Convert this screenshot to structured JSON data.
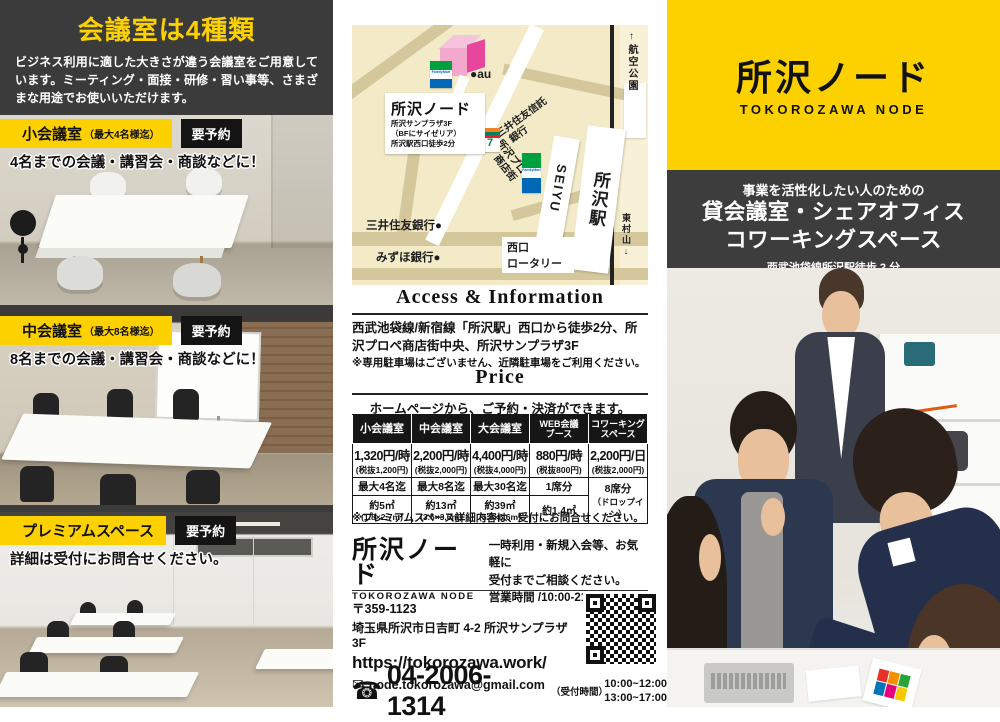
{
  "brand": {
    "logo_jp": "所沢ノード",
    "logo_en": "TOKOROZAWA NODE"
  },
  "colors": {
    "yellow": "#fdd000",
    "dark": "#3b3b3b",
    "black": "#161616",
    "map_bg": "#f3eac8",
    "pink": "#e8459f"
  },
  "icons": {
    "email": "✉",
    "phone": "☎"
  },
  "left": {
    "title": "会議室は4種類",
    "description": "ビジネス利用に適した大きさが違う会議室をご用意しています。ミーティング・面接・研修・習い事等、さまざまな用途でお使いいただけます。",
    "rooms": [
      {
        "name": "小会議室",
        "note": "（最大4名様迄）",
        "badge": "要予約",
        "caption": "4名までの会議・講習会・商談などに！"
      },
      {
        "name": "中会議室",
        "note": "（最大8名様迄）",
        "badge": "要予約",
        "caption": "8名までの会議・講習会・商談などに！"
      },
      {
        "name": "プレミアムスペース",
        "note": "",
        "badge": "要予約",
        "caption": "詳細は受付にお問合せください。"
      }
    ]
  },
  "map": {
    "callout": {
      "title": "所沢ノード",
      "line1": "所沢サンプラザ3F",
      "line2": "（BFにサイゼリア）",
      "line3": "所沢駅西口徒歩2分"
    },
    "labels": {
      "airport_park": "↑航空公園",
      "au": "●au",
      "smbc_trust1": "●三井住友信託",
      "smbc_trust2": "銀行",
      "prope1": "所沢プロペ",
      "prope2": "商店街",
      "seiyu": "SEIYU",
      "station": "所沢駅",
      "smbc": "三井住友銀行●",
      "mizuho": "みずほ銀行●",
      "rotary1": "西口",
      "rotary2": "ロータリー",
      "higashimurayama": "東村山↓",
      "familymart": "FamilyMart",
      "seven": "7"
    }
  },
  "access": {
    "title": "Access & Information",
    "body": "西武池袋線/新宿線「所沢駅」西口から徒歩2分、所沢プロペ商店街中央、所沢サンプラザ3F",
    "note": "※専用駐車場はございません、近隣駐車場をご利用ください。"
  },
  "price": {
    "title": "Price",
    "subtitle": "ホームページから、ご予約・決済ができます。",
    "note": "※プレミアムスペース詳細内容は、受付にお問合せください。",
    "columns": [
      {
        "h1": "小会議室",
        "price": "1,320円/時",
        "tax": "(税抜1,200円)",
        "capacity": "最大4名迄",
        "size": "約5㎡",
        "size2": "(1.8×2.7m)"
      },
      {
        "h1": "中会議室",
        "price": "2,200円/時",
        "tax": "(税抜2,000円)",
        "capacity": "最大8名迄",
        "size": "約13㎡",
        "size2": "(3.6×3.6m)"
      },
      {
        "h1": "大会議室",
        "price": "4,400円/時",
        "tax": "(税抜4,000円)",
        "capacity": "最大30名迄",
        "size": "約39㎡",
        "size2": "(5.9×6.6m)"
      },
      {
        "h1": "WEB会議",
        "h2": "ブース",
        "price": "880円/時",
        "tax": "(税抜800円)",
        "capacity": "1席分",
        "size": "約1.4㎡",
        "size2": ""
      },
      {
        "h1": "コワーキング",
        "h2": "スペース",
        "price": "2,200円/日",
        "tax": "(税抜2,000円)",
        "capacity": "8席分",
        "dropin": "（ドロップイン）"
      }
    ]
  },
  "contact": {
    "consult1": "一時利用・新規入会等、お気軽に",
    "consult2": "受付までご相談ください。",
    "hours": "営業時間 /10:00-21:00",
    "postal": "〒359-1123",
    "address": "埼玉県所沢市日吉町 4-2 所沢サンプラザ 3F",
    "url": "https://tokorozawa.work/",
    "email": "node.tokorozawa@gmail.com",
    "phone": "04-2006-1314",
    "reception_label": "（受付時間）",
    "reception1": "10:00~12:00",
    "reception2": "13:00~17:00"
  },
  "right": {
    "tagline": "事業を活性化したい人のための",
    "headline1": "貸会議室・シェアオフィス",
    "headline2": "コワーキングスペース",
    "subline": "西武池袋線所沢駅徒歩 2 分"
  }
}
